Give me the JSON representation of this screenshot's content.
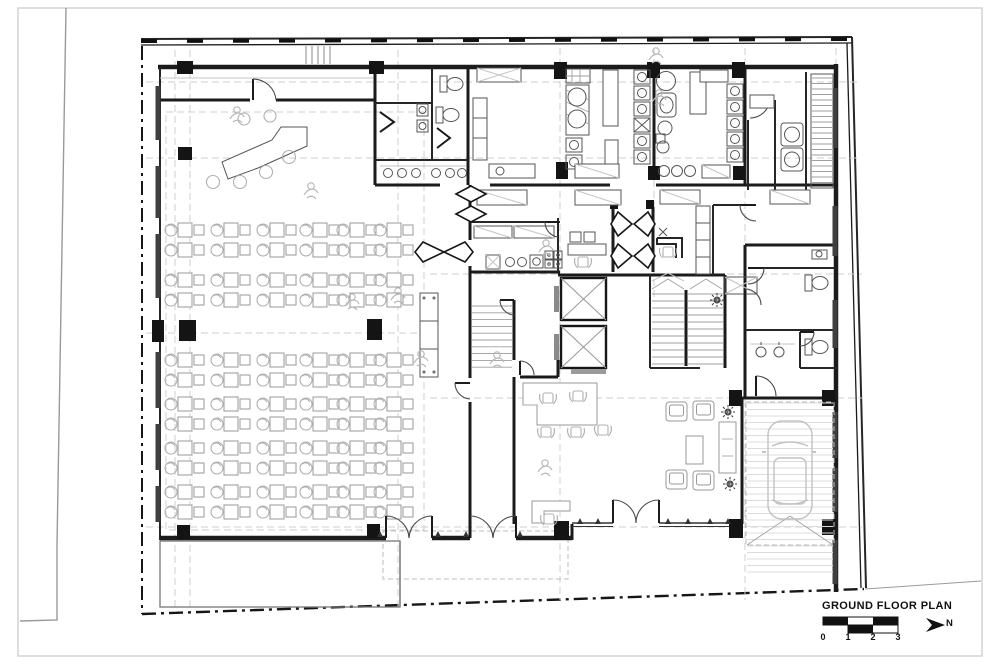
{
  "title_block": {
    "title": "GROUND FLOOR PLAN",
    "scale_labels": [
      "0",
      "1",
      "2",
      "3"
    ],
    "north_label": "N"
  },
  "colors": {
    "ink": "#141414",
    "wall": "#1b1b1b",
    "furniture": "#9a9a9a",
    "light_detail": "#c6c6c6",
    "dashed_grid": "#cfcfcf",
    "paper": "#ffffff",
    "sheet_border": "#c8c8c8"
  }
}
